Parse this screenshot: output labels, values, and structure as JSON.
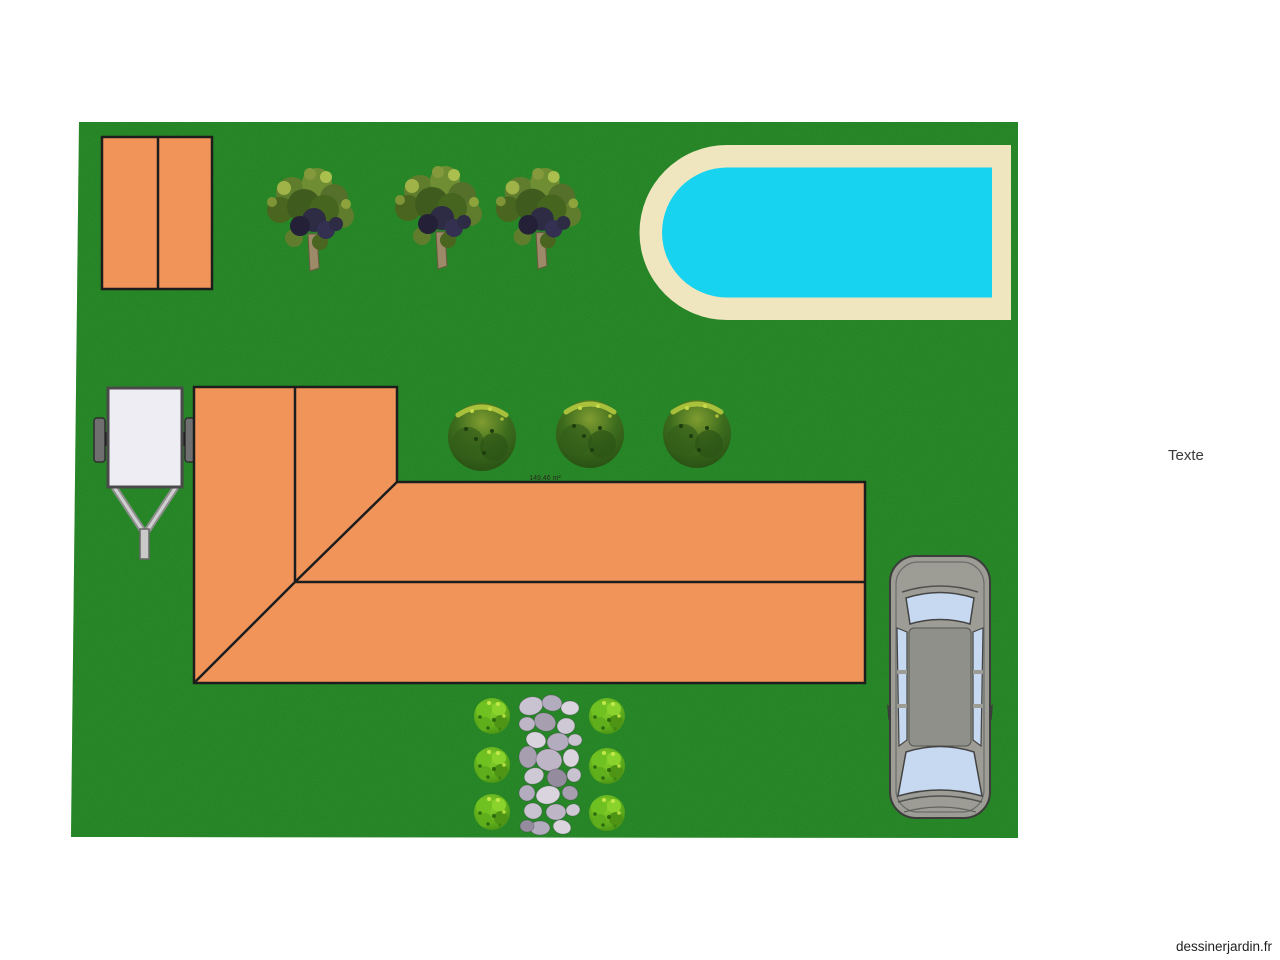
{
  "page": {
    "watermark": "dessinerjardin.fr",
    "background_color": "#ffffff"
  },
  "plan": {
    "text_label": "Texte",
    "house": {
      "area_label": "149.46 m²"
    },
    "counts": {
      "trees": 3,
      "hedge_bushes": 3,
      "small_bushes": 6,
      "stones_path": 1,
      "vehicles": 2
    },
    "colors": {
      "lawn_green": "#237d23",
      "structure_orange": "#f0945a",
      "outline_dark": "#1d1d1d",
      "pool_deck_cream": "#efe6c0",
      "pool_water_cyan": "#17d3f0",
      "car_body_gray": "#9d9d95",
      "car_glass_blue": "#c7d9f0",
      "trailer_body_white": "#ededf3",
      "stone_gray": "#c0b9c9"
    }
  }
}
